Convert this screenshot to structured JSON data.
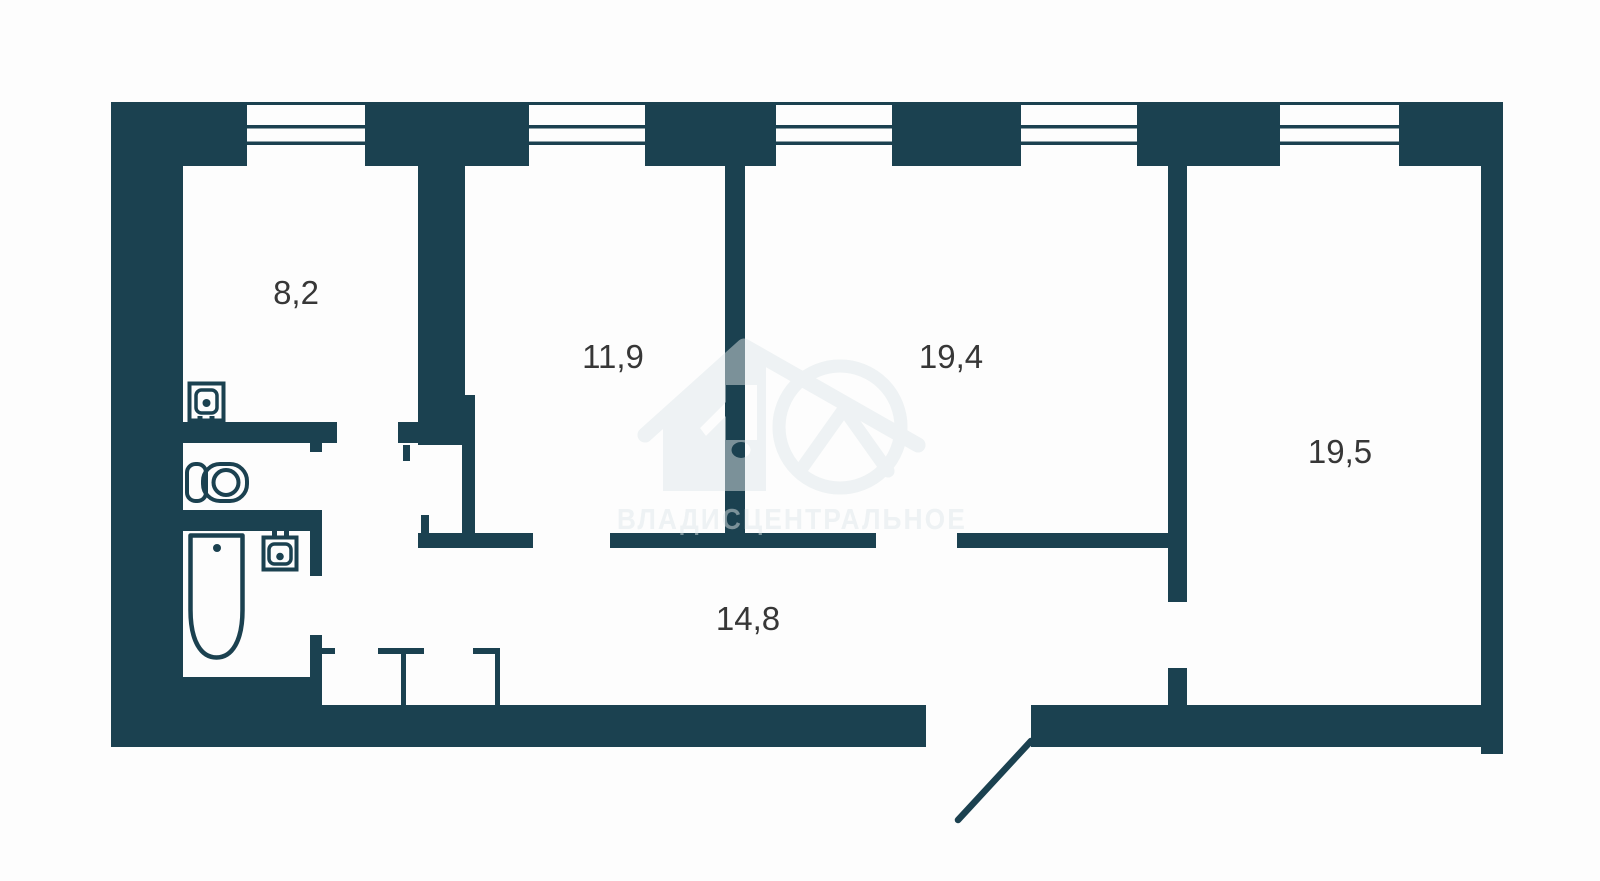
{
  "plan": {
    "type": "apartment-floor-plan",
    "wall_color": "#1b4150",
    "background_color": "#fdfdfd",
    "label_color": "#373737",
    "rooms": [
      {
        "name": "kitchen",
        "area_label": "8,2"
      },
      {
        "name": "bedroom-small",
        "area_label": "11,9"
      },
      {
        "name": "living-room",
        "area_label": "19,4"
      },
      {
        "name": "bedroom-large",
        "area_label": "19,5"
      },
      {
        "name": "hallway",
        "area_label": "14,8"
      }
    ],
    "window_count": 5,
    "fixtures": [
      "kitchen-sink",
      "toilet",
      "washbasin",
      "bathtub"
    ],
    "watermark": {
      "text": "ВЛАДИСЦЕНТРАЛЬНОЕ",
      "logo": "house-logo-with-ring"
    }
  }
}
